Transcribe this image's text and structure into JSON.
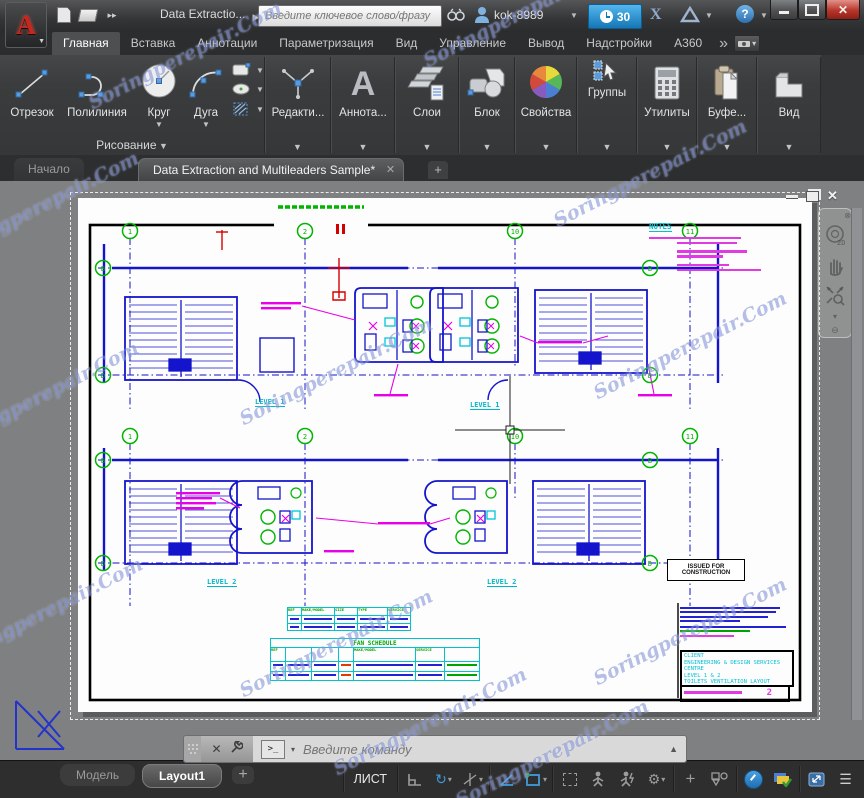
{
  "watermark": {
    "text": "Soringperepair.Com"
  },
  "title_bar": {
    "title": "Data Extractio...",
    "search_placeholder": "Введите ключевое слово/фразу",
    "user": "kok-8989",
    "trial_badge": "30",
    "help_label": "?"
  },
  "ribbon": {
    "tabs": [
      "Главная",
      "Вставка",
      "Аннотации",
      "Параметризация",
      "Вид",
      "Управление",
      "Вывод",
      "Надстройки",
      "A360"
    ],
    "overflow": "»",
    "draw_buttons": [
      "Отрезок",
      "Полилиния",
      "Круг",
      "Дуга"
    ],
    "draw_panel_label": "Рисование",
    "panel_buttons": [
      "Редакти...",
      "Аннота...",
      "Слои",
      "Блок",
      "Свойства",
      "Группы",
      "Утилиты",
      "Буфе...",
      "Вид"
    ]
  },
  "file_tabs": {
    "start": "Начало",
    "active": "Data Extraction and Multileaders Sample*",
    "add": "+"
  },
  "drawing": {
    "notes_title": "NOTES",
    "level1": "LEVEL 1",
    "level2": "LEVEL 2",
    "issued_line1": "ISSUED FOR",
    "issued_line2": "CONSTRUCTION",
    "fan_schedule_title": "FAN SCHEDULE",
    "table1_headers": [
      "REF",
      "MAKE/MODEL",
      "SIZE",
      "TYPE",
      "SERVICE"
    ],
    "fan_headers": [
      "REF",
      "MAKE/MODEL",
      "SERVICE"
    ],
    "title_block": {
      "line1": "CLIENT",
      "line2": "ENGINEERING & DESIGN SERVICES CENTRE",
      "line3": "LEVEL 1 & 2",
      "line4": "TOILETS VENTILATION LAYOUT",
      "sheet_no": "2"
    },
    "bubbles_row1": [
      "1",
      "2",
      "10",
      "11",
      "B",
      "D",
      "B",
      "D"
    ],
    "bubbles_row2": [
      "1",
      "2",
      "10",
      "11",
      "B",
      "D",
      "B",
      "D"
    ],
    "nav_2d_label": "2D"
  },
  "command_line": {
    "prompt": "&gt;_",
    "placeholder": "Введите команду"
  },
  "status_bar": {
    "model_tab": "Модель",
    "layout_tab": "Layout1",
    "add_tab": "+",
    "space_label": "ЛИСТ"
  }
}
